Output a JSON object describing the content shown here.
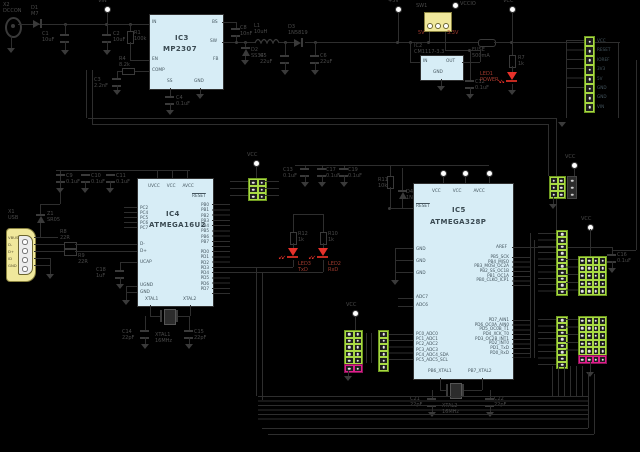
{
  "palette": {
    "bg": "#000000",
    "wire": "#2e2e2e",
    "text_gray": "#4a4a4a",
    "accent_red": "#a03a2e",
    "ic_fill": "#d7edf6",
    "header_green": "#a8d944",
    "header_magenta": "#df1f8c",
    "part_yellow": "#f0e89c",
    "led_red": "#e8312a"
  },
  "labels": {
    "x2": "X2\nDCCON",
    "d1": "D1\nM7",
    "vin": "VIN",
    "c1": "C1\n10uF",
    "c2": "C2\n10uF",
    "r1": "R1\n100k",
    "r4": "R4\n8.2k",
    "c3": "C3\n2.2nF",
    "c4": "C4\n0.1uF",
    "c8": "C8\n10nF",
    "d2": "D2\nSS34",
    "l1": "L1\n10uH",
    "c5": "C5\n22uF",
    "d3": "D3\n1N5819",
    "c6": "C6\n22uF",
    "p5v": "+5V",
    "fuse": "FUSE\n500mA",
    "vcc": "VCC",
    "r7": "R7\n1k",
    "led1": "LED1\nPOWER",
    "sw1": "SW1",
    "sw_5v": "5V",
    "sw_33": "3.3V",
    "vccio": "VCCIO",
    "ic2_lbl": "IC2\nCM1117-3.3",
    "c12": "C12\n0.1uF",
    "x1": "X1\nUSB",
    "z1": "Z1\nSR05",
    "r8": "R8\n22R",
    "r9": "R9\n22R",
    "c9": "C9\n0.1uF",
    "c10": "C10\n0.1uF",
    "c11": "C11\n0.1uF",
    "c18": "C18\n1uF",
    "q1": "XTAL1\n16MHz",
    "c14": "C14\n22pF",
    "c15": "C15\n22pF",
    "r12": "R12\n1k",
    "r10": "R10\n1k",
    "led3": "LED3\nTxD",
    "led2": "LED2\nRxD",
    "c13a": "C13\n0.1uF",
    "c13b": "C17\n0.1uF",
    "c13c": "C19\n0.1uF",
    "r11": "R11\n10k",
    "d4": "D4\n1N4148",
    "q2": "XTAL2\n16MHz",
    "c21": "C21\n22pF",
    "c22": "C22\n22pF",
    "c16": "C16\n0.1uF",
    "vcc2": "VCC",
    "vcc3": "VCC",
    "vcc4": "VCC",
    "vcc5": "VCC"
  },
  "ics": {
    "ic2": {
      "in": "IN",
      "out": "OUT",
      "gnd": "GND"
    },
    "ic3": {
      "name": "IC3",
      "part": "MP2307",
      "in": "IN",
      "en": "EN",
      "comp": "COMP",
      "ss": "SS",
      "gnd": "GND",
      "bs": "BS",
      "sw": "SW",
      "fb": "FB"
    },
    "ic4": {
      "name": "IC4",
      "part": "ATMEGA16U2",
      "top": [
        "UVCC",
        "VCC",
        "AVCC"
      ],
      "reset": "RESET",
      "pc": [
        "PC2",
        "PC4",
        "PC5",
        "PC6",
        "PC7"
      ],
      "dm": "D-",
      "dp": "D+",
      "ucap": "UCAP",
      "ugnd": "UGND",
      "gnd": "GND",
      "xtal1": "XTAL1",
      "xtal2": "XTAL2",
      "pb": [
        "PB0",
        "PB1",
        "PB2",
        "PB3",
        "PB4",
        "PB5",
        "PB6",
        "PB7"
      ],
      "pd": [
        "PD0",
        "PD1",
        "PD2",
        "PD3",
        "PD4",
        "PD5",
        "PD6",
        "PD7"
      ]
    },
    "ic5": {
      "name": "IC5",
      "part": "ATMEGA328P",
      "top": [
        "VCC",
        "VCC",
        "AVCC"
      ],
      "reset": "RESET",
      "gnds": [
        "GND",
        "GND",
        "GND"
      ],
      "adc7": "ADC7",
      "adc6": "ADC6",
      "pc": [
        "PC0_ADC0",
        "PC1_ADC1",
        "PC2_ADC2",
        "PC3_ADC3",
        "PC4_ADC4_SDA",
        "PC5_ADC5_SCL"
      ],
      "aref": "AREF",
      "pb": [
        "PB5_SCK",
        "PB4_MISO",
        "PB3_MOSI_OC2A",
        "PB2_SS_OC1B",
        "PB1_OC1A",
        "PB0_CLKO_ICP1"
      ],
      "pd": [
        "PD7_AIN1",
        "PD6_OC0A_AIN0",
        "PD5_OC0B_T1",
        "PD4_XCK_T0",
        "PD3_OC2B_INT1",
        "PD2_INT0",
        "PD1_TxD",
        "PD0_RxD"
      ],
      "xtal1": "PB6_XTAL1",
      "xtal2": "PB7_XTAL2"
    }
  },
  "connectors": {
    "x1_pins": [
      "VBUS",
      "D-",
      "D+",
      "ID",
      "GND"
    ],
    "power_header_labels": [
      "VCC",
      "RESET",
      "IOREF",
      "3V3",
      "5V",
      "GND",
      "GND",
      "VIN"
    ]
  },
  "cells": {
    "n2": [
      0,
      1
    ],
    "n3": [
      0,
      1,
      2
    ],
    "n4": [
      0,
      1,
      2,
      3
    ],
    "n6": [
      0,
      1,
      2,
      3,
      4,
      5
    ],
    "n8": [
      0,
      1,
      2,
      3,
      4,
      5,
      6,
      7
    ],
    "n10": [
      0,
      1,
      2,
      3,
      4,
      5,
      6,
      7,
      8,
      9
    ],
    "n20": [
      0,
      1,
      2,
      3,
      4,
      5,
      6,
      7,
      8,
      9,
      10,
      11,
      12,
      13,
      14,
      15,
      16,
      17,
      18,
      19
    ]
  }
}
